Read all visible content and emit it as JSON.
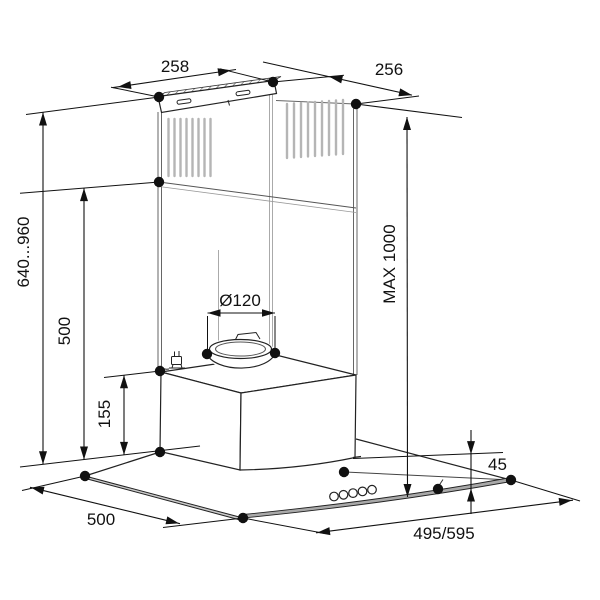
{
  "diagram": {
    "type": "technical-drawing",
    "subject": "cooker-hood-installation-dimensions",
    "dimensions": {
      "bracket_width": "258",
      "top_depth": "256",
      "chimney_height_range": "640...960",
      "chimney_lower_height": "500",
      "duct_diameter": "Ø120",
      "max_overall_height": "MAX 1000",
      "body_height": "155",
      "glass_edge_height": "45",
      "canopy_depth": "500",
      "canopy_width": "495/595"
    },
    "colors": {
      "line": "#1a1a1a",
      "secondary_line": "#6b6b6b",
      "vent_slot": "#b5b5b5",
      "glass_band": "#a9a9a9",
      "background": "#ffffff"
    }
  }
}
